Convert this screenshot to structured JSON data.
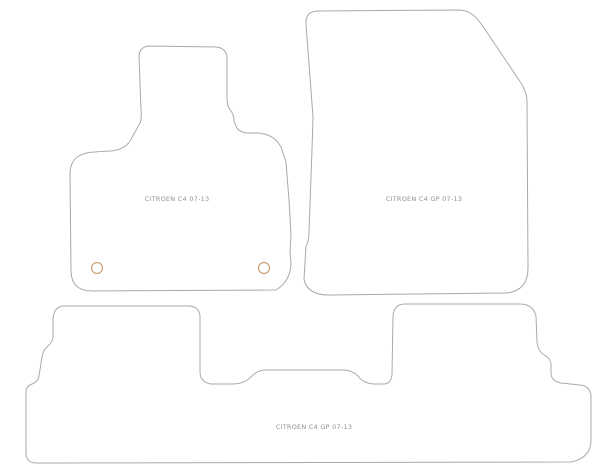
{
  "diagram": {
    "background_color": "#ffffff",
    "outline_color": "#a9a9a9",
    "label_color": "#909090",
    "fixing_ring_color": "#c9a277",
    "mats": {
      "driver": {
        "label": "CITROEN C4 07-13"
      },
      "passenger": {
        "label": "CITROEN C4 GP 07-13"
      },
      "rear": {
        "label": "CITROEN C4 GP 07-13"
      }
    }
  }
}
